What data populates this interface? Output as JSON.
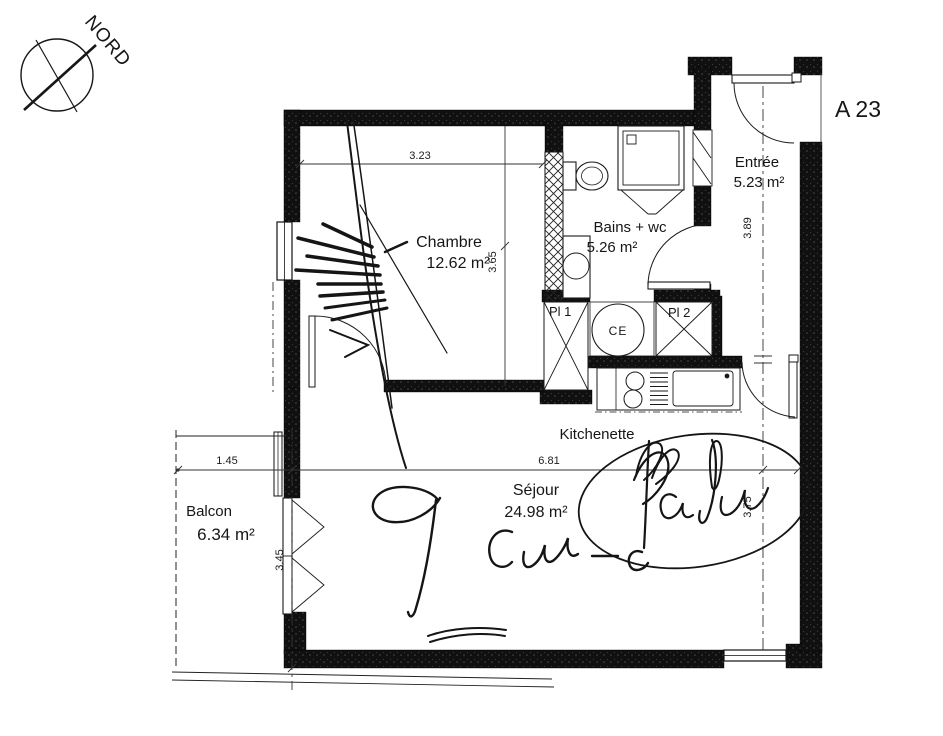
{
  "plan": {
    "unit_label": "A 23",
    "compass_label": "NORD",
    "rooms": {
      "chambre": {
        "name": "Chambre",
        "area": "12.62 m²"
      },
      "bains": {
        "name": "Bains + wc",
        "area": "5.26 m²"
      },
      "entree": {
        "name": "Entrée",
        "area": "5.23 m²"
      },
      "sejour": {
        "name": "Séjour",
        "area": "24.98 m²"
      },
      "balcon": {
        "name": "Balcon",
        "area": "6.34 m²"
      },
      "kitchenette": {
        "name": "Kitchenette"
      }
    },
    "storage": {
      "pl1": "Pl 1",
      "pl2": "Pl 2",
      "water_heater": "CE"
    },
    "dimensions": {
      "chambre_width": "3.23",
      "chambre_depth": "3.65",
      "entree_depth": "3.89",
      "balcon_width": "1.45",
      "balcon_depth": "3.45",
      "sejour_width": "6.81",
      "sejour_depth": "3.75"
    },
    "colors": {
      "wall": "#0e0e0e",
      "line": "#1a1a1a",
      "paper": "#ffffff"
    }
  }
}
